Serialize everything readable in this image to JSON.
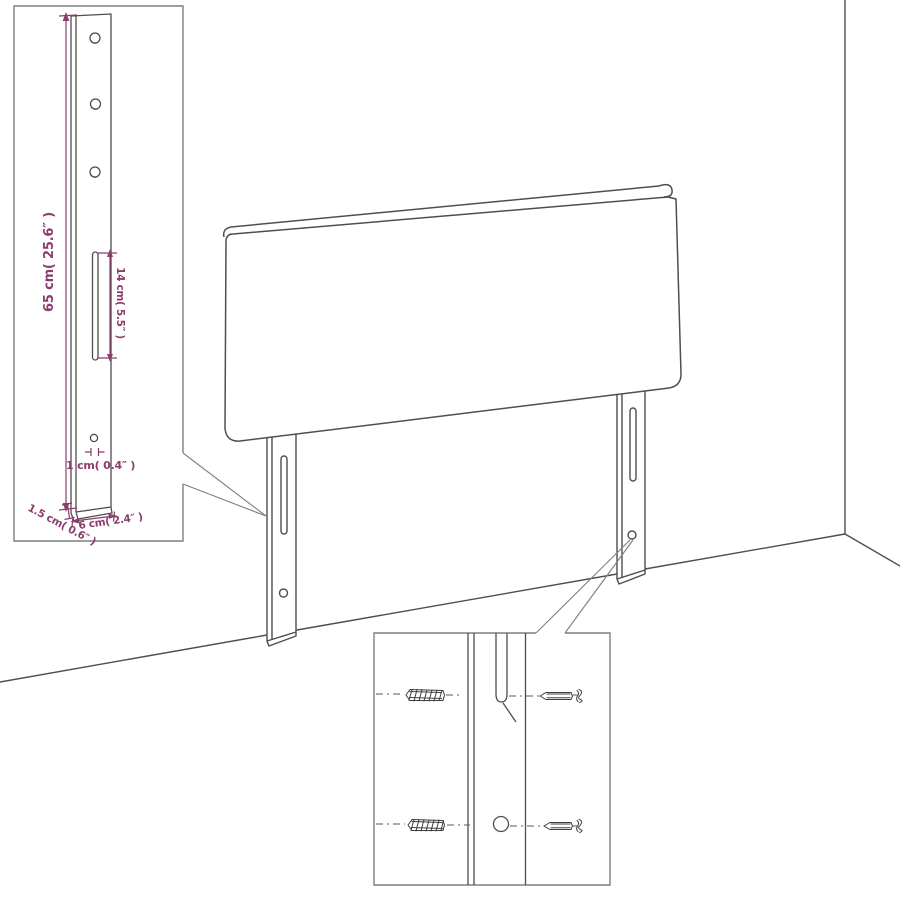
{
  "diagram": {
    "type": "product-dimension-diagram",
    "subject": "upholstered headboard with two slotted legs, corner-room backdrop, zoom insets",
    "colors": {
      "line": "#4e4e4e",
      "dimension": "#8b3d6d",
      "inset_border": "#7f7f7f",
      "background": "#ffffff"
    },
    "insets": {
      "leg_detail": {
        "labels": {
          "height": "65 cm( 25.6″ )",
          "slot_length": "14 cm( 5.5″ )",
          "hole": "1 cm( 0.4″ )",
          "thickness": "1.5 cm( 0.6″ )",
          "width": "6 cm( 2.4″ )"
        }
      },
      "hardware_detail": {
        "icons": [
          "wall-plug-anchor",
          "screw"
        ]
      }
    }
  }
}
